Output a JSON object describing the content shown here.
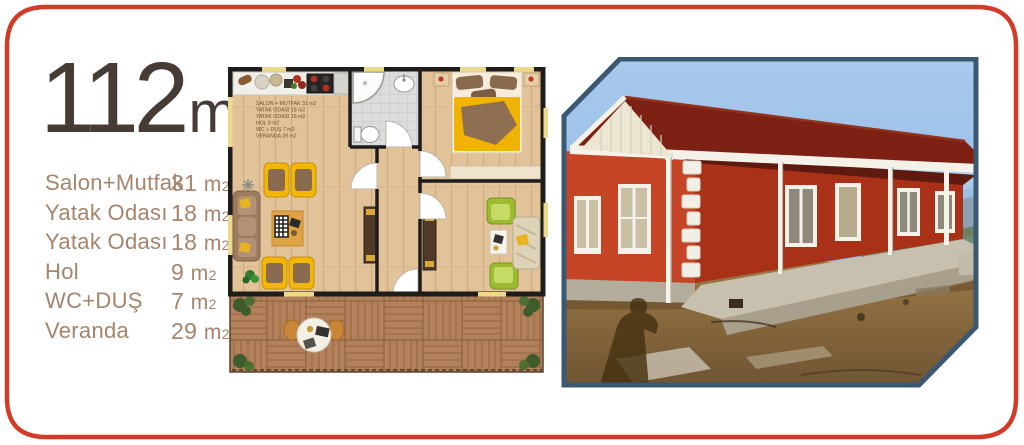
{
  "title": {
    "area_number": "112",
    "unit": "m",
    "unit_sup": "2"
  },
  "unit": {
    "m": "m",
    "sub": "2"
  },
  "rooms": [
    {
      "label": "Salon+Mutfak",
      "value": "31"
    },
    {
      "label": "Yatak Odası",
      "value": "18"
    },
    {
      "label": "Yatak Odası",
      "value": "18"
    },
    {
      "label": "Hol",
      "value": "9"
    },
    {
      "label": "WC+DUŞ",
      "value": "7"
    },
    {
      "label": "Veranda",
      "value": "29"
    }
  ],
  "floor_plan": {
    "legend": [
      "SALON + MUTFAK 31 m2",
      "YATAK ODASI 18 m2",
      "YATAK ODASI 18 m2",
      "HOL 9 m2",
      "WC + DUŞ 7 m2",
      "VERANDA 29 m2"
    ]
  },
  "colors": {
    "frame_red": "#d23b27",
    "title_brown": "#463b35",
    "list_tan": "#a5846b",
    "photo_frame_navy": "#3b5873",
    "house_red": "#c04124",
    "roof_dark_red": "#7c2114"
  }
}
